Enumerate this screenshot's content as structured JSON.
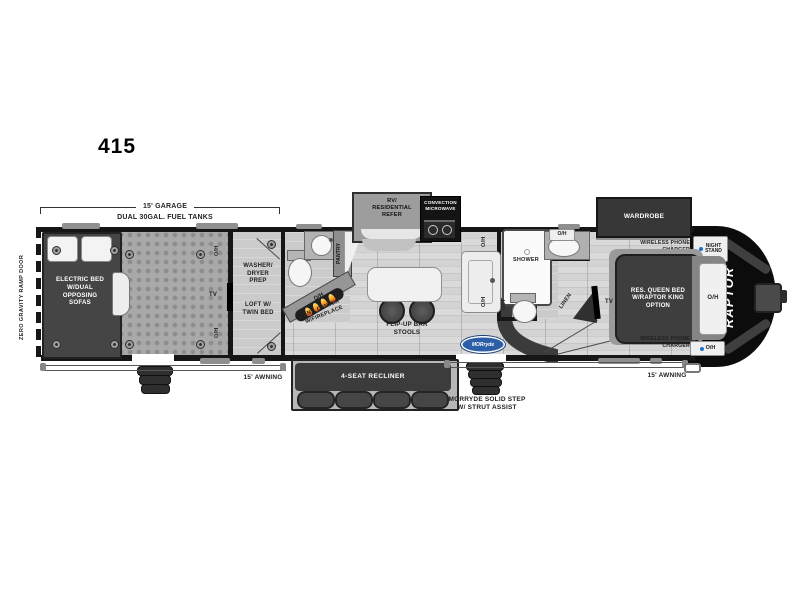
{
  "title": "415",
  "exterior": {
    "ramp_door": "ZERO GRAVITY RAMP DOOR",
    "garage_length": "15' GARAGE",
    "fuel_tanks": "DUAL 30GAL. FUEL TANKS",
    "awning_left": "15' AWNING",
    "awning_right": "15' AWNING",
    "step_label": "MORRYDE SOLID STEP\nW/ STRUT ASSIST",
    "morryde_logo": "MORryde",
    "brand": "RAPTOR"
  },
  "garage": {
    "bed": "ELECTRIC BED\nW/DUAL\nOPPOSING\nSOFAS",
    "oh_top": "O/H",
    "oh_bottom": "O/H",
    "tv": "TV"
  },
  "loft_room": {
    "washer": "WASHER/\nDRYER\nPREP",
    "loft": "LOFT W/\nTWIN BED"
  },
  "mid_bath": {
    "pantry": "PANTRY",
    "oh": "O/H",
    "ent_center": "ENT. CENTER\nW/FIREPLACE"
  },
  "kitchen": {
    "refer": "RV/\nRESIDENTIAL\nREFER",
    "microwave": "CONVECTION\nMICROWAVE",
    "oh_top": "O/H",
    "oh_bottom": "O/H",
    "bar": "FLIP-UP BAR\nSTOOLS"
  },
  "living": {
    "recliner": "4-SEAT RECLINER"
  },
  "main_bath": {
    "shower": "SHOWER",
    "oh_toilet": "O/H",
    "oh_vanity": "O/H",
    "linen": "LINEN"
  },
  "bedroom": {
    "wardrobe": "WARDROBE",
    "wireless_top": "WIRELESS PHONE\nCHARGER",
    "night_stand": "NIGHT\nSTAND",
    "bed": "RES. QUEEN BED\nW/RAPTOR KING\nOPTION",
    "oh_headboard": "O/H",
    "oh_foot": "O/H",
    "wireless_bottom": "WIRELESS PHONE\nCHARGER",
    "tv": "TV"
  },
  "colors": {
    "wall": "#161616",
    "accent_blue": "#2d5fa8",
    "flame": "#f6a21c"
  }
}
